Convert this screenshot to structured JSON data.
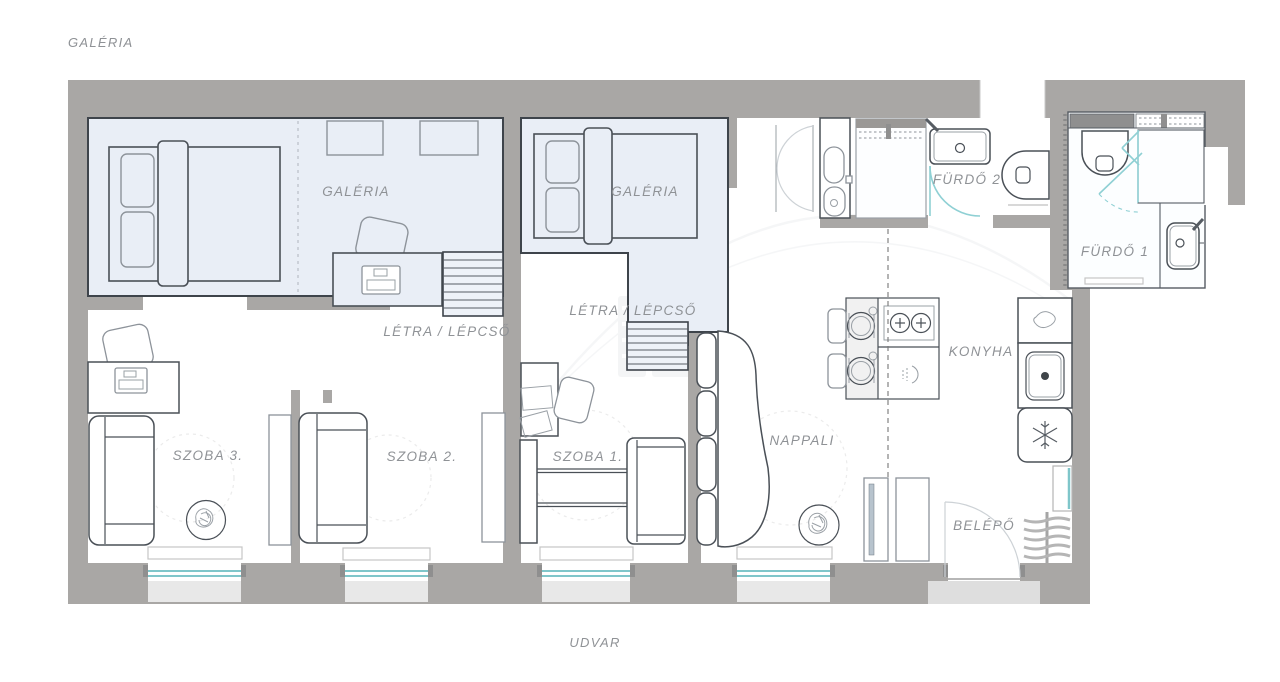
{
  "plan": {
    "title_top": "GALÉRIA",
    "title_bottom": "UDVAR",
    "rooms": {
      "galeria_left": "GALÉRIA",
      "galeria_middle": "GALÉRIA",
      "stairs_left": "LÉTRA / LÉPCSŐ",
      "stairs_middle": "LÉTRA / LÉPCSŐ",
      "szoba1": "SZOBA 1.",
      "szoba2": "SZOBA 2.",
      "szoba3": "SZOBA 3.",
      "nappali": "NAPPALI",
      "konyha": "KONYHA",
      "belepo": "BELÉPŐ",
      "furdo1": "FÜRDŐ 1",
      "furdo2": "FÜRDŐ 2"
    },
    "colors": {
      "wall": "#a9a7a5",
      "gallery_fill": "#e9eef6",
      "outline": "#3e444b",
      "window_glass": "#7fc6ca",
      "label_text": "#8f9296",
      "sill": "#e8e8e8"
    }
  }
}
